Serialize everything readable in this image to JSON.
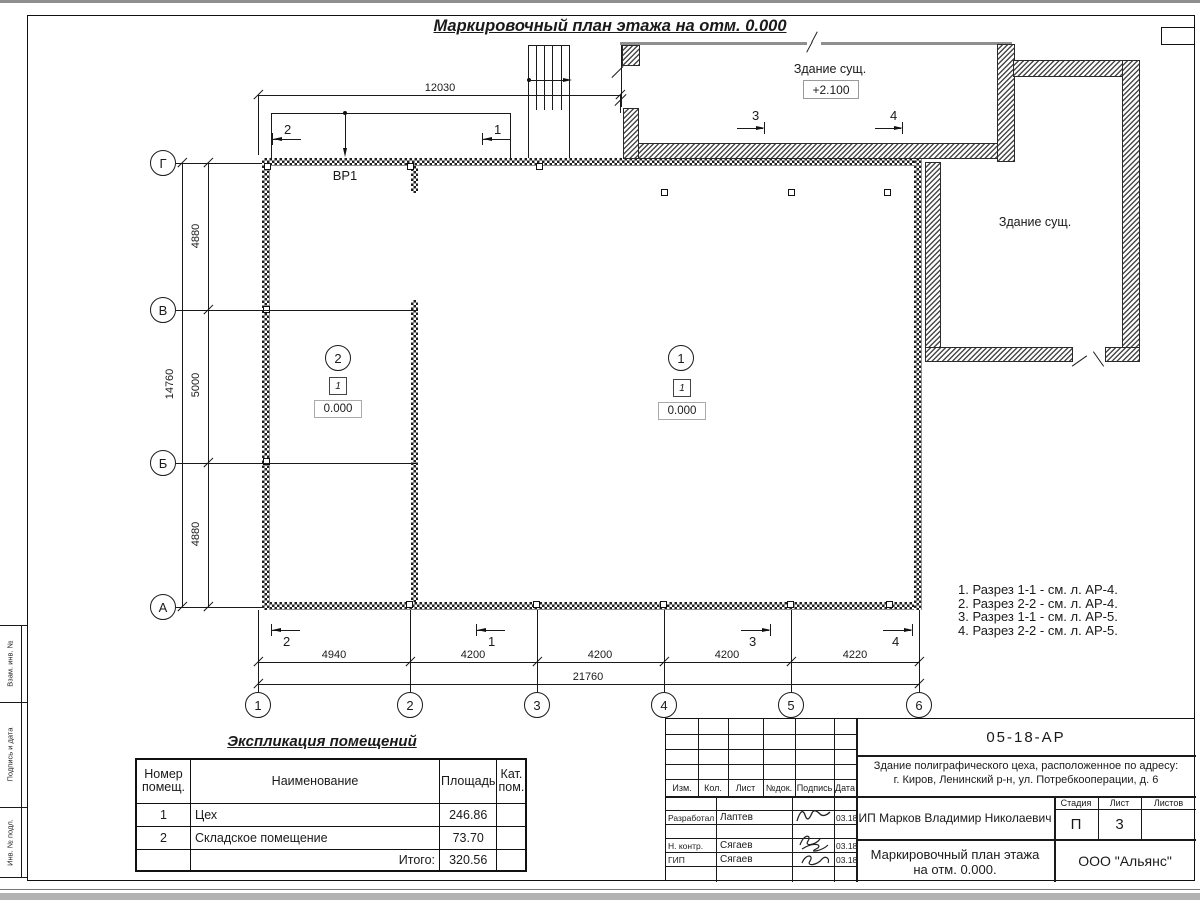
{
  "sheet": {
    "title": "Маркировочный план этажа на отм. 0.000"
  },
  "axes": {
    "rows": [
      "Г",
      "В",
      "Б",
      "А"
    ],
    "cols": [
      "1",
      "2",
      "3",
      "4",
      "5",
      "6"
    ]
  },
  "dims": {
    "top": "12030",
    "left": [
      "4880",
      "5000",
      "4880"
    ],
    "left_total": "14760",
    "bottom": [
      "4940",
      "4200",
      "4200",
      "4200",
      "4220"
    ],
    "bottom_total": "21760"
  },
  "plan": {
    "vr1": "ВР1",
    "existing_top": {
      "label": "Здание сущ.",
      "elev": "+2.100"
    },
    "existing_right": {
      "label": "Здание сущ."
    },
    "rooms": [
      {
        "num": "2",
        "cat": "1",
        "elev": "0.000"
      },
      {
        "num": "1",
        "cat": "1",
        "elev": "0.000"
      }
    ],
    "sections": {
      "s1": "1",
      "s2": "2",
      "s3": "3",
      "s4": "4"
    }
  },
  "notes": [
    "1. Разрез 1-1 - см. л. АР-4.",
    "2. Разрез 2-2 - см. л. АР-4.",
    "3. Разрез 1-1 - см. л. АР-5.",
    "4. Разрез 2-2 - см. л. АР-5."
  ],
  "explication": {
    "title": "Экспликация помещений",
    "headers": {
      "num": "Номер помещ.",
      "name": "Наименование",
      "area": "Площадь",
      "cat": "Кат. пом."
    },
    "rows": [
      {
        "num": "1",
        "name": "Цех",
        "area": "246.86",
        "cat": ""
      },
      {
        "num": "2",
        "name": "Складское помещение",
        "area": "73.70",
        "cat": ""
      }
    ],
    "total_label": "Итого:",
    "total_value": "320.56"
  },
  "titleblock": {
    "doc_number": "05-18-АР",
    "object": "Здание полиграфического цеха, расположенное по адресу:",
    "address": "г. Киров,  Ленинский р-н, ул. Потребкооперации, д. 6",
    "client": "ИП Марков Владимир Николаевич",
    "sheet_title_1": "Маркировочный план этажа",
    "sheet_title_2": "на отм. 0.000.",
    "company": "ООО \"Альянс\"",
    "stage_label": "Стадия",
    "sheet_label": "Лист",
    "sheets_label": "Листов",
    "stage": "П",
    "sheet_no": "3",
    "sheets_total": "",
    "cols": {
      "izm": "Изм.",
      "kol": "Кол.",
      "list": "Лист",
      "doc": "№док.",
      "sign": "Подпись",
      "date": "Дата"
    },
    "rows": [
      {
        "role": "Разработал",
        "name": "Лаптев",
        "date": "03.18"
      },
      {
        "role": "Н. контр.",
        "name": "Сягаев",
        "date": "03.18"
      },
      {
        "role": "ГИП",
        "name": "Сягаев",
        "date": "03.18"
      }
    ]
  },
  "side_stamp": [
    "Взам. инв. №",
    "Подпись и дата",
    "Инв. № подл."
  ]
}
